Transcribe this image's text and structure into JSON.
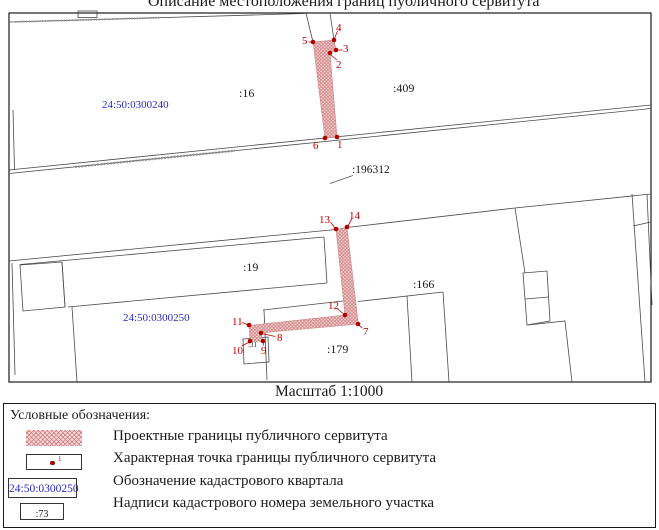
{
  "title": "Описание местоположения границ публичного сервитута",
  "map": {
    "scale_label": "Масштаб 1:1000",
    "cadastral_quarters": {
      "q240": "24:50:0300240",
      "q250": "24:50:0300250"
    },
    "parcels": {
      "p16": ":16",
      "p409": ":409",
      "p196312": ":196312",
      "p19": ":19",
      "p166": ":166",
      "p179": ":179",
      "p31": ":31"
    },
    "points": [
      "1",
      "2",
      "3",
      "4",
      "5",
      "6",
      "7",
      "8",
      "9",
      "10",
      "11",
      "12",
      "13",
      "14"
    ]
  },
  "legend": {
    "header": "Условные обозначения:",
    "items": [
      {
        "label": "Проектные границы публичного сервитута",
        "swatch": "hatch-area"
      },
      {
        "label": "Характерная точка границы публичного сервитута",
        "swatch": "boundary-point",
        "point_number": "1"
      },
      {
        "label": "Обозначение кадастрового квартала",
        "swatch": "quarter-number",
        "sample": "24:50:0300250"
      },
      {
        "label": "Надписи кадастрового номера земельного участка",
        "swatch": "parcel-number",
        "sample": ":73"
      }
    ]
  },
  "colors": {
    "servitude_fill": "#f7d7d7",
    "servitude_hatch": "#cc7777",
    "point": "#aa0000",
    "point_label": "#c00000",
    "quarter_label": "#2929c8",
    "line": "#4a4a4a"
  }
}
